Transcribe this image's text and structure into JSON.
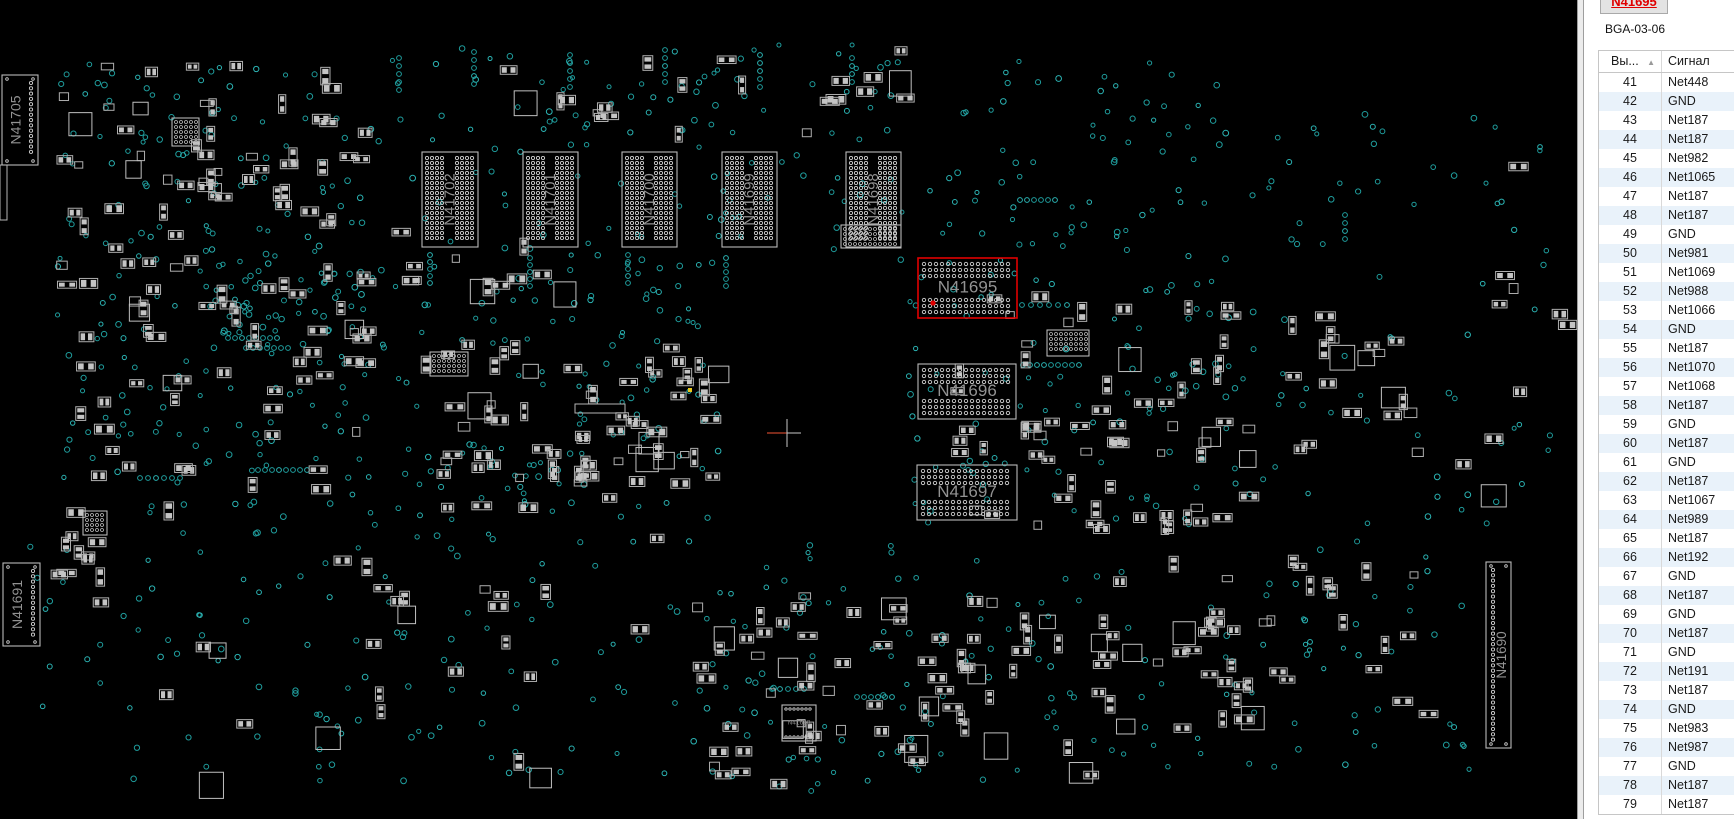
{
  "panel": {
    "selected_component_button": "N41695",
    "package": "BGA-03-06",
    "table": {
      "columns": [
        "Вы...",
        "Сигнал"
      ],
      "sort_icon": "▲",
      "rows": [
        {
          "pin": "41",
          "signal": "Net448"
        },
        {
          "pin": "42",
          "signal": "GND"
        },
        {
          "pin": "43",
          "signal": "Net187"
        },
        {
          "pin": "44",
          "signal": "Net187"
        },
        {
          "pin": "45",
          "signal": "Net982"
        },
        {
          "pin": "46",
          "signal": "Net1065"
        },
        {
          "pin": "47",
          "signal": "Net187"
        },
        {
          "pin": "48",
          "signal": "Net187"
        },
        {
          "pin": "49",
          "signal": "GND"
        },
        {
          "pin": "50",
          "signal": "Net981"
        },
        {
          "pin": "51",
          "signal": "Net1069"
        },
        {
          "pin": "52",
          "signal": "Net988"
        },
        {
          "pin": "53",
          "signal": "Net1066"
        },
        {
          "pin": "54",
          "signal": "GND"
        },
        {
          "pin": "55",
          "signal": "Net187"
        },
        {
          "pin": "56",
          "signal": "Net1070"
        },
        {
          "pin": "57",
          "signal": "Net1068"
        },
        {
          "pin": "58",
          "signal": "Net187"
        },
        {
          "pin": "59",
          "signal": "GND"
        },
        {
          "pin": "60",
          "signal": "Net187"
        },
        {
          "pin": "61",
          "signal": "GND"
        },
        {
          "pin": "62",
          "signal": "Net187"
        },
        {
          "pin": "63",
          "signal": "Net1067"
        },
        {
          "pin": "64",
          "signal": "Net989"
        },
        {
          "pin": "65",
          "signal": "Net187"
        },
        {
          "pin": "66",
          "signal": "Net192"
        },
        {
          "pin": "67",
          "signal": "GND"
        },
        {
          "pin": "68",
          "signal": "Net187"
        },
        {
          "pin": "69",
          "signal": "GND"
        },
        {
          "pin": "70",
          "signal": "Net187"
        },
        {
          "pin": "71",
          "signal": "GND"
        },
        {
          "pin": "72",
          "signal": "Net191"
        },
        {
          "pin": "73",
          "signal": "Net187"
        },
        {
          "pin": "74",
          "signal": "GND"
        },
        {
          "pin": "75",
          "signal": "Net983"
        },
        {
          "pin": "76",
          "signal": "Net987"
        },
        {
          "pin": "77",
          "signal": "GND"
        },
        {
          "pin": "78",
          "signal": "Net187"
        },
        {
          "pin": "79",
          "signal": "Net187"
        }
      ]
    },
    "colors": {
      "button_text": "#e00000",
      "row_alt": "#e9f2fa",
      "border": "#c6c6c6"
    }
  },
  "board": {
    "background": "#000000",
    "via_colors": [
      "#1f9d9d",
      "#2bb3b3"
    ],
    "component_color": "#aeaeae",
    "pad_fill": "#c4c4c4",
    "label_color": "#929292",
    "highlight_color": "#e00000",
    "components": [
      {
        "ref": "N41705",
        "x": 2,
        "y": 75,
        "w": 36,
        "h": 90,
        "type": "connector-v",
        "pads": "right"
      },
      {
        "ref": "N41702",
        "x": 422,
        "y": 152,
        "w": 56,
        "h": 95,
        "type": "ic-grid-v"
      },
      {
        "ref": "N41701",
        "x": 523,
        "y": 152,
        "w": 55,
        "h": 95,
        "type": "ic-grid-v"
      },
      {
        "ref": "N41700",
        "x": 622,
        "y": 152,
        "w": 55,
        "h": 95,
        "type": "ic-grid-v"
      },
      {
        "ref": "N41699",
        "x": 722,
        "y": 152,
        "w": 55,
        "h": 95,
        "type": "ic-grid-v"
      },
      {
        "ref": "N41698",
        "x": 846,
        "y": 152,
        "w": 55,
        "h": 95,
        "type": "ic-grid-v"
      },
      {
        "ref": "N41695",
        "x": 918,
        "y": 258,
        "w": 99,
        "h": 60,
        "type": "ic-grid-h",
        "highlighted": true
      },
      {
        "ref": "N41696",
        "x": 918,
        "y": 364,
        "w": 98,
        "h": 55,
        "type": "ic-grid-h"
      },
      {
        "ref": "N41697",
        "x": 917,
        "y": 465,
        "w": 100,
        "h": 55,
        "type": "ic-grid-h"
      },
      {
        "ref": "N41691",
        "x": 3,
        "y": 563,
        "w": 37,
        "h": 83,
        "type": "connector-v",
        "pads": "right"
      },
      {
        "ref": "N41690",
        "x": 1486,
        "y": 562,
        "w": 25,
        "h": 186,
        "type": "connector-v",
        "pads": "left"
      },
      {
        "ref": "N41688",
        "x": 782,
        "y": 705,
        "w": 34,
        "h": 36,
        "type": "ic-small"
      }
    ],
    "selected_pin": {
      "x": 933,
      "y": 303
    },
    "cursor_cross": {
      "x": 787,
      "y": 433
    },
    "yellow_via": {
      "x": 690,
      "y": 390
    },
    "texture": {
      "via_clusters": [
        {
          "x": 55,
          "y": 60,
          "w": 310,
          "h": 280,
          "n": 130
        },
        {
          "x": 370,
          "y": 45,
          "w": 530,
          "h": 100,
          "n": 70
        },
        {
          "x": 390,
          "y": 145,
          "w": 510,
          "h": 115,
          "n": 50
        },
        {
          "x": 200,
          "y": 255,
          "w": 300,
          "h": 270,
          "n": 110
        },
        {
          "x": 500,
          "y": 255,
          "w": 220,
          "h": 265,
          "n": 90
        },
        {
          "x": 900,
          "y": 180,
          "w": 360,
          "h": 350,
          "n": 140
        },
        {
          "x": 1260,
          "y": 90,
          "w": 290,
          "h": 470,
          "n": 70
        },
        {
          "x": 30,
          "y": 530,
          "w": 280,
          "h": 260,
          "n": 45
        },
        {
          "x": 310,
          "y": 520,
          "w": 380,
          "h": 270,
          "n": 70
        },
        {
          "x": 690,
          "y": 540,
          "w": 400,
          "h": 260,
          "n": 95
        },
        {
          "x": 1090,
          "y": 550,
          "w": 380,
          "h": 220,
          "n": 60
        },
        {
          "x": 60,
          "y": 350,
          "w": 150,
          "h": 170,
          "n": 35
        },
        {
          "x": 940,
          "y": 60,
          "w": 300,
          "h": 120,
          "n": 40
        }
      ],
      "via_chains": [
        {
          "dir": "h",
          "x": 228,
          "y": 338,
          "n": 8,
          "pitch": 7
        },
        {
          "dir": "h",
          "x": 246,
          "y": 348,
          "n": 7,
          "pitch": 7
        },
        {
          "dir": "h",
          "x": 140,
          "y": 478,
          "n": 6,
          "pitch": 8
        },
        {
          "dir": "h",
          "x": 258,
          "y": 470,
          "n": 8,
          "pitch": 7
        },
        {
          "dir": "h",
          "x": 772,
          "y": 689,
          "n": 5,
          "pitch": 8
        },
        {
          "dir": "h",
          "x": 857,
          "y": 697,
          "n": 6,
          "pitch": 7
        },
        {
          "dir": "v",
          "x": 399,
          "y": 58,
          "n": 5,
          "pitch": 8
        },
        {
          "dir": "v",
          "x": 474,
          "y": 52,
          "n": 5,
          "pitch": 8
        },
        {
          "dir": "v",
          "x": 570,
          "y": 55,
          "n": 5,
          "pitch": 8
        },
        {
          "dir": "v",
          "x": 665,
          "y": 50,
          "n": 5,
          "pitch": 8
        },
        {
          "dir": "v",
          "x": 760,
          "y": 55,
          "n": 5,
          "pitch": 8
        },
        {
          "dir": "v",
          "x": 852,
          "y": 58,
          "n": 4,
          "pitch": 8
        },
        {
          "dir": "v",
          "x": 430,
          "y": 255,
          "n": 5,
          "pitch": 7
        },
        {
          "dir": "v",
          "x": 530,
          "y": 258,
          "n": 5,
          "pitch": 7
        },
        {
          "dir": "v",
          "x": 628,
          "y": 255,
          "n": 5,
          "pitch": 7
        },
        {
          "dir": "v",
          "x": 726,
          "y": 258,
          "n": 5,
          "pitch": 7
        },
        {
          "dir": "h",
          "x": 1020,
          "y": 200,
          "n": 6,
          "pitch": 7
        },
        {
          "dir": "h",
          "x": 1022,
          "y": 305,
          "n": 6,
          "pitch": 9
        },
        {
          "dir": "h",
          "x": 1023,
          "y": 365,
          "n": 9,
          "pitch": 7
        },
        {
          "dir": "v",
          "x": 1345,
          "y": 215,
          "n": 4,
          "pitch": 8
        }
      ],
      "component_clusters": [
        {
          "x": 55,
          "y": 60,
          "w": 310,
          "h": 280,
          "n": 85
        },
        {
          "x": 60,
          "y": 340,
          "w": 300,
          "h": 180,
          "n": 30
        },
        {
          "x": 420,
          "y": 340,
          "w": 290,
          "h": 140,
          "n": 65
        },
        {
          "x": 470,
          "y": 40,
          "w": 430,
          "h": 95,
          "n": 22
        },
        {
          "x": 950,
          "y": 290,
          "w": 300,
          "h": 240,
          "n": 65
        },
        {
          "x": 690,
          "y": 590,
          "w": 340,
          "h": 190,
          "n": 55
        },
        {
          "x": 1090,
          "y": 555,
          "w": 330,
          "h": 170,
          "n": 38
        },
        {
          "x": 45,
          "y": 505,
          "w": 60,
          "h": 95,
          "n": 10
        },
        {
          "x": 1280,
          "y": 300,
          "w": 140,
          "h": 150,
          "n": 20
        },
        {
          "x": 330,
          "y": 490,
          "w": 330,
          "h": 150,
          "n": 18
        },
        {
          "x": 905,
          "y": 600,
          "w": 330,
          "h": 180,
          "n": 25
        },
        {
          "x": 380,
          "y": 225,
          "w": 180,
          "h": 70,
          "n": 12
        },
        {
          "x": 1440,
          "y": 90,
          "w": 120,
          "h": 420,
          "n": 10
        },
        {
          "x": 140,
          "y": 640,
          "w": 400,
          "h": 140,
          "n": 12
        }
      ],
      "grid_blocks": [
        {
          "x": 172,
          "y": 118,
          "w": 27,
          "h": 28
        },
        {
          "x": 841,
          "y": 225,
          "w": 60,
          "h": 23
        },
        {
          "x": 1047,
          "y": 330,
          "w": 42,
          "h": 26
        },
        {
          "x": 430,
          "y": 352,
          "w": 38,
          "h": 24
        },
        {
          "x": 83,
          "y": 511,
          "w": 24,
          "h": 24
        }
      ],
      "plain_blocks": [
        {
          "x": 575,
          "y": 404,
          "w": 50,
          "h": 9
        },
        {
          "x": 0,
          "y": 165,
          "w": 7,
          "h": 55
        }
      ]
    }
  }
}
